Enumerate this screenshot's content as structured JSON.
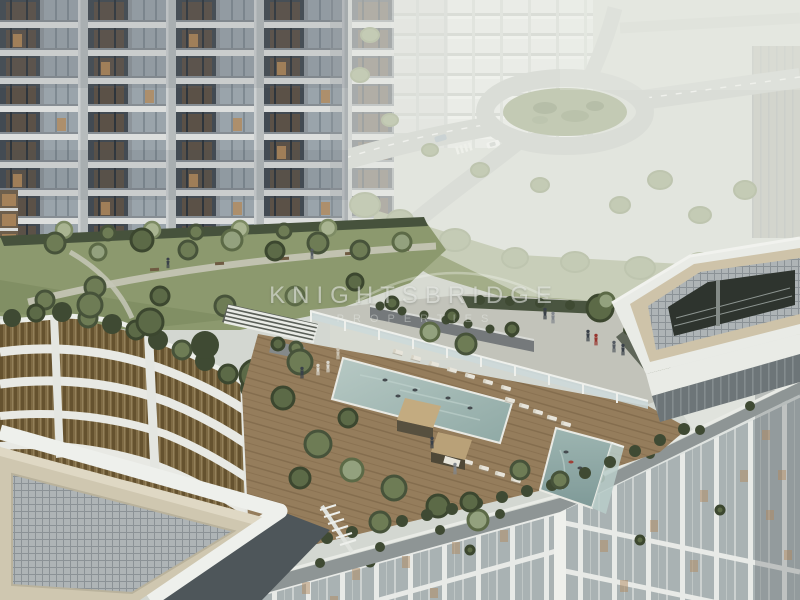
{
  "watermark": {
    "brand": "KNIGHTSBRIDGE",
    "tagline": "PROPERTIES"
  },
  "scene": {
    "type": "architectural-rendering",
    "subject": "Aerial view of a high-rise residential tower with a rooftop amenity deck: landscaped garden terrace, infinity swimming pool with swimmers, sun loungers, cabanas, glass pool fence, walkway with people, rooftop pergola pavilion, bronze louvered podium facade, white canopy roof in the foreground, and a faded city streetscape with a roundabout in the background",
    "elements": [
      "residential-tower",
      "rooftop-garden",
      "infinity-pool",
      "sun-loungers",
      "cabanas",
      "glass-pool-fence",
      "terrace-walkway",
      "pergola-pavilion",
      "bronze-louver-podium",
      "canopy-roof",
      "city-roundabout",
      "background-buildings",
      "swimmers",
      "pedestrians"
    ]
  },
  "palette": {
    "haze_background": "#d5d9d3",
    "tower_concrete": "#b6bbbc",
    "tower_glass": "#9aa4ab",
    "window_dark": "#424a52",
    "warm_light": "#b28a5d",
    "lawn_green": "#8c996e",
    "tree_dark": "#3c472f",
    "tree_mid": "#6e7c55",
    "tree_light": "#93a17e",
    "pool_water": "#9fb7b2",
    "deck_wood": "#957d5c",
    "lounger_white": "#e7e4da",
    "bronze_louver": "#7e6a44",
    "facade_white": "#eef0ec",
    "facade_glass": "#a9b2b3",
    "canopy_mesh": "#aeb4b6",
    "white_wash": "#edefe9"
  }
}
